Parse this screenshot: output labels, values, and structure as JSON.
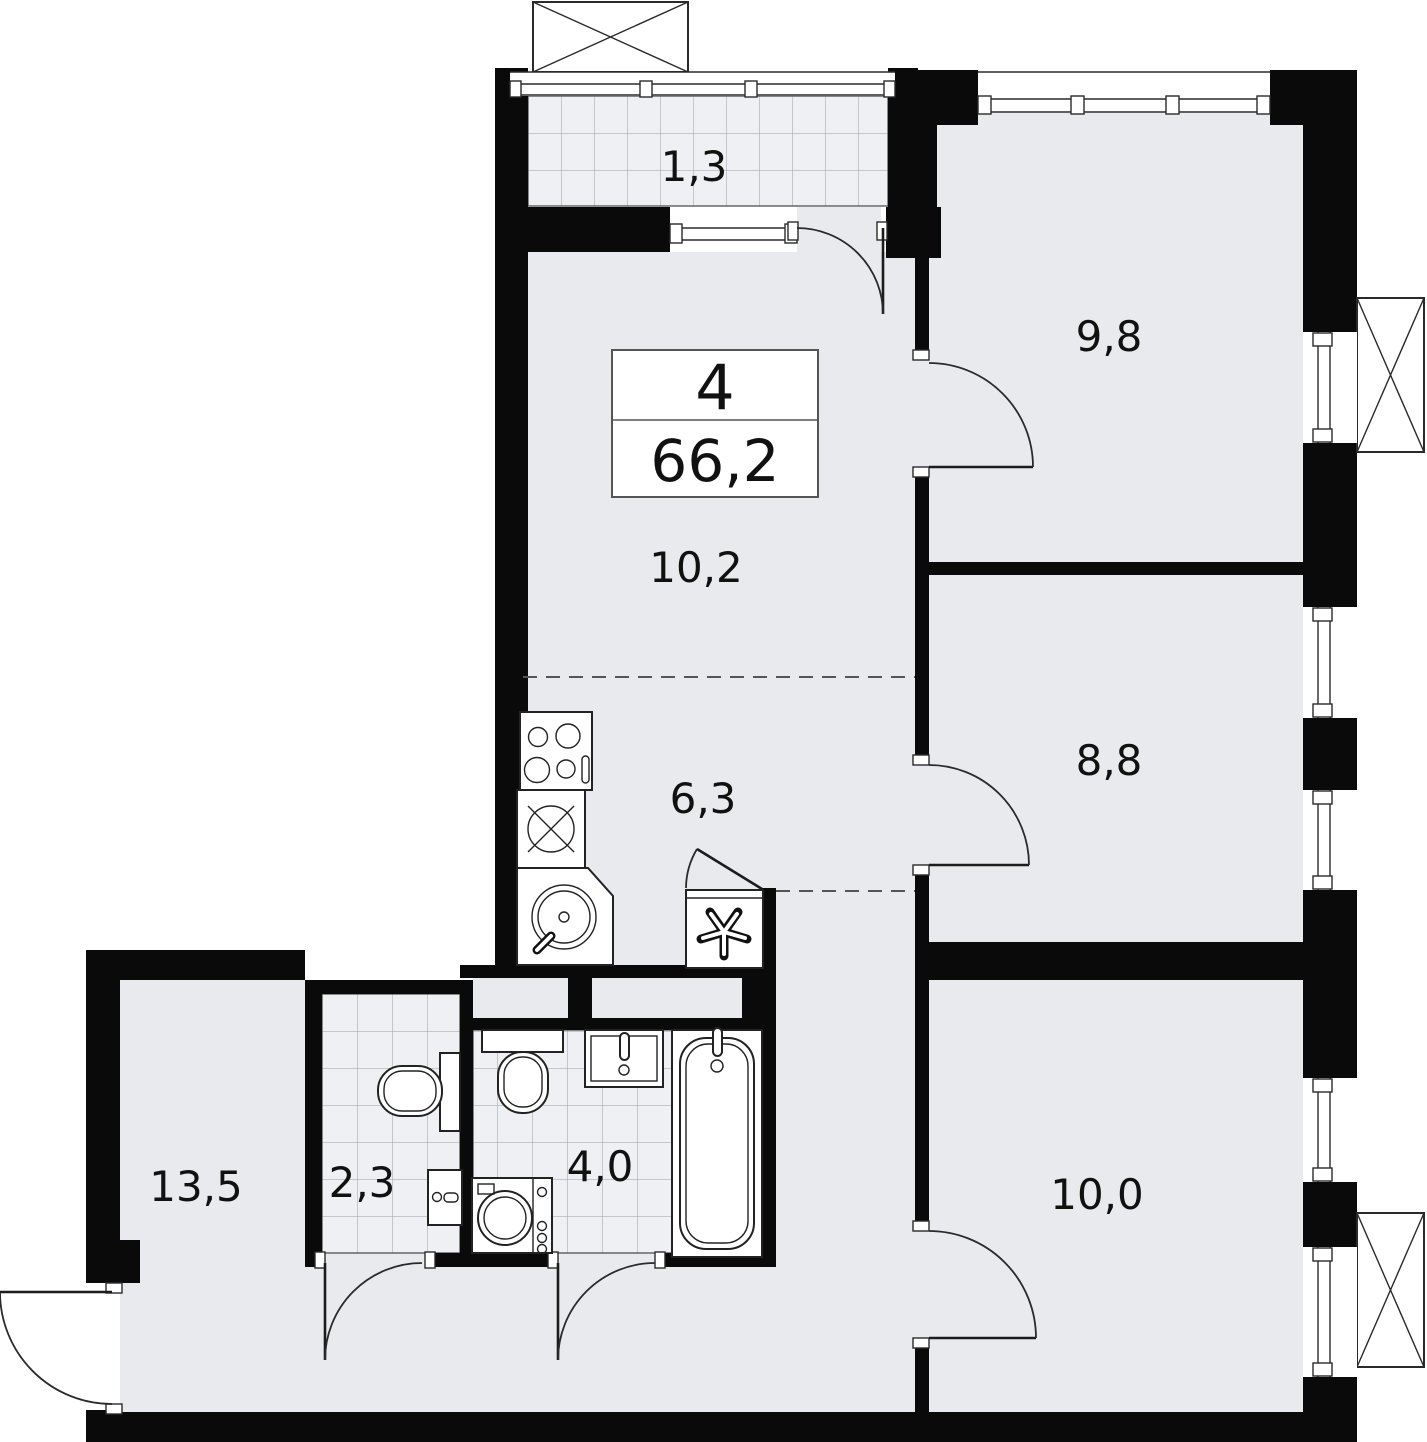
{
  "floorplan": {
    "summary": {
      "rooms_count": "4",
      "total_area": "66,2"
    },
    "room_labels": {
      "balcony": "1,3",
      "bedroom_top": "9,8",
      "living_kitchen": "10,2",
      "kitchen_zone": "6,3",
      "bedroom_middle": "8,8",
      "living_room": "13,5",
      "wc": "2,3",
      "bathroom": "4,0",
      "bedroom_bottom": "10,0"
    },
    "colors": {
      "wall": "#0a0a0a",
      "floor": "#e8eaee",
      "tile_floor": "#eef0f3",
      "line": "#2a2a2a",
      "text": "#111111"
    }
  }
}
